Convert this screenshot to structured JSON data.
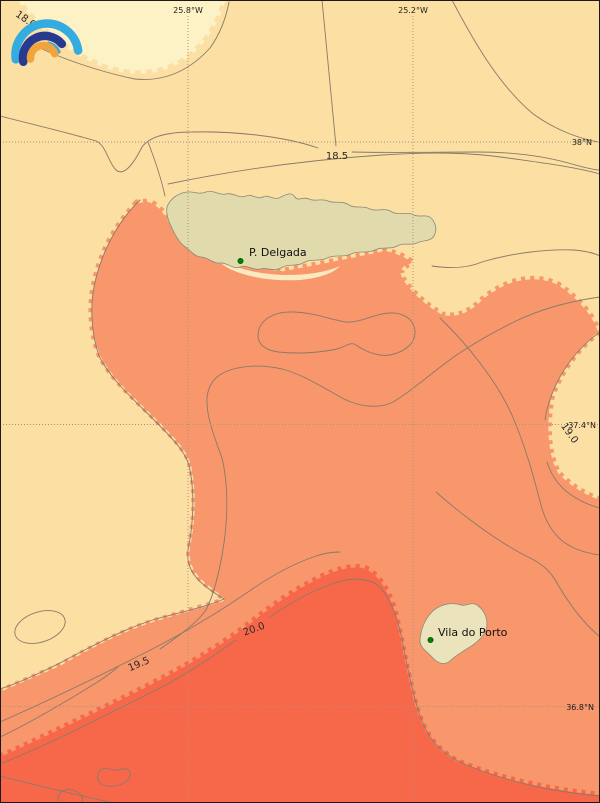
{
  "map": {
    "kind": "filled-contour temperature map",
    "lon_labels": [
      {
        "text": "25.8°W"
      },
      {
        "text": "25.2°W"
      }
    ],
    "lat_labels": [
      {
        "text": "38°N"
      },
      {
        "text": "37.4°N"
      },
      {
        "text": "36.8°N"
      }
    ],
    "contour_labels": [
      {
        "text": "18.0"
      },
      {
        "text": "18.5"
      },
      {
        "text": "19.0"
      },
      {
        "text": "19.5"
      },
      {
        "text": "20.0"
      }
    ],
    "places": [
      {
        "name": "P. Delgada"
      },
      {
        "name": "Vila do Porto"
      }
    ],
    "levels": [
      18.0,
      18.5,
      19.0,
      19.5,
      20.0
    ],
    "colors": {
      "band_lt_18": "#FDF1C6",
      "band_18_19": "#FBDFA3",
      "band_19_20": "#F8966C",
      "band_gt_20": "#F7684B",
      "island_sao_miguel": "#E0DAAD",
      "island_santa_maria": "#EBE3BC",
      "island_shore_strip": "#F9E9BE",
      "contour_line": "#8A7A68",
      "grid_line": "#A6947F",
      "place_marker": "#008000",
      "frame": "#1a1a1a",
      "logo_light_blue": "#35ACE0",
      "logo_dark_blue": "#283A8F",
      "logo_orange": "#F2A33C"
    }
  }
}
